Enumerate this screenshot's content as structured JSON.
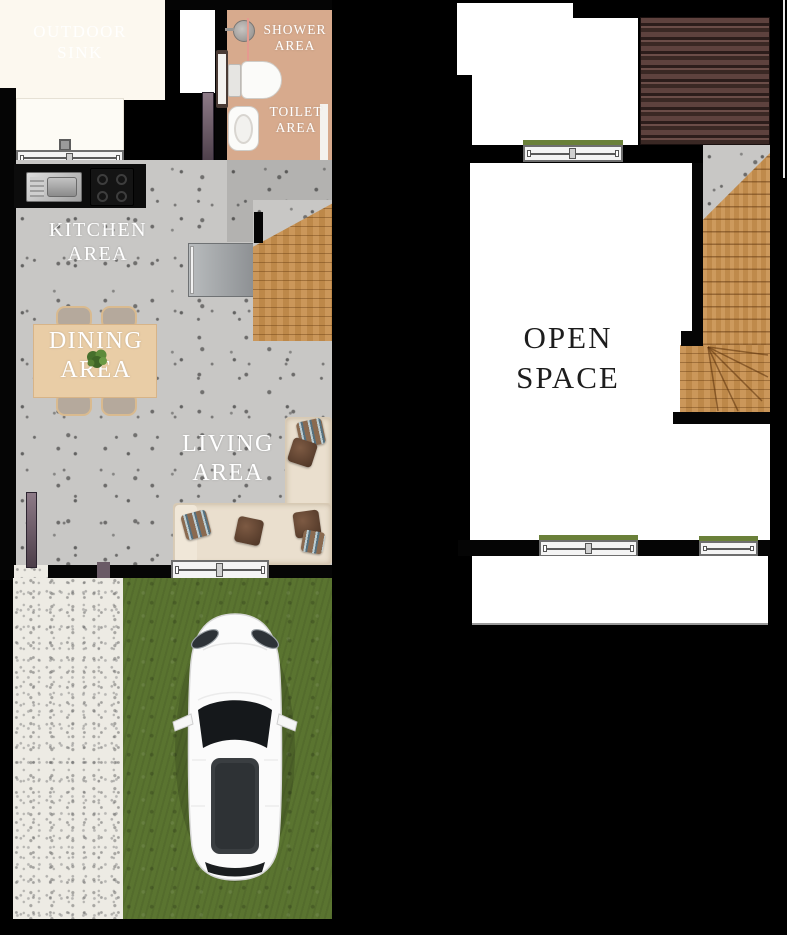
{
  "plan": {
    "type": "two-storey townhouse floor plan",
    "ground_floor_labels": {
      "outdoor_sink": {
        "l1": "OUTDOOR",
        "l2": "SINK"
      },
      "shower": {
        "l1": "SHOWER",
        "l2": "AREA"
      },
      "toilet": {
        "l1": "TOILET",
        "l2": "AREA"
      },
      "kitchen": {
        "l1": "KITCHEN",
        "l2": "AREA"
      },
      "dining": {
        "l1": "DINING",
        "l2": "AREA"
      },
      "living": {
        "l1": "LIVING",
        "l2": "AREA"
      }
    },
    "upper_floor_labels": {
      "open_space": {
        "l1": "OPEN",
        "l2": "SPACE"
      }
    },
    "colors": {
      "background": "#000000",
      "wall": "#050505",
      "bathroom_floor": "#d7aa8d",
      "concrete_floor": "#c8c7c5",
      "wood_stairs": "#c78f4d",
      "dining_table": "#e9cda6",
      "sofa": "#eadfce",
      "grass": "#5a7430",
      "gravel": "#edebe4",
      "roof_deck": "#553c38",
      "outdoor_sink_area": "#fcf8ef",
      "door_leaf": "#7d6a78",
      "car_body": "#fbfbfb",
      "window_sill_green": "#6a8039"
    },
    "icons": {
      "shower-head-icon": "gray circle with arm",
      "toilet-icon": "white tank + rounded bowl",
      "washbasin-icon": "white oval basin",
      "kitchen-sink-icon": "steel rectangle with bowl",
      "stove-icon": "black hob with 4 burners",
      "refrigerator-icon": "gray rectangle with handle",
      "dining-table-icon": "wood rectangle with 4 chairs",
      "plant-icon": "green foliage cluster",
      "sofa-icon": "L-shaped sectional with pillows",
      "stairs-icon": "wood planks with winder fan",
      "window-icon": "double casement frame",
      "door-icon": "dark swing leaf",
      "car-icon": "white sedan top view"
    }
  }
}
